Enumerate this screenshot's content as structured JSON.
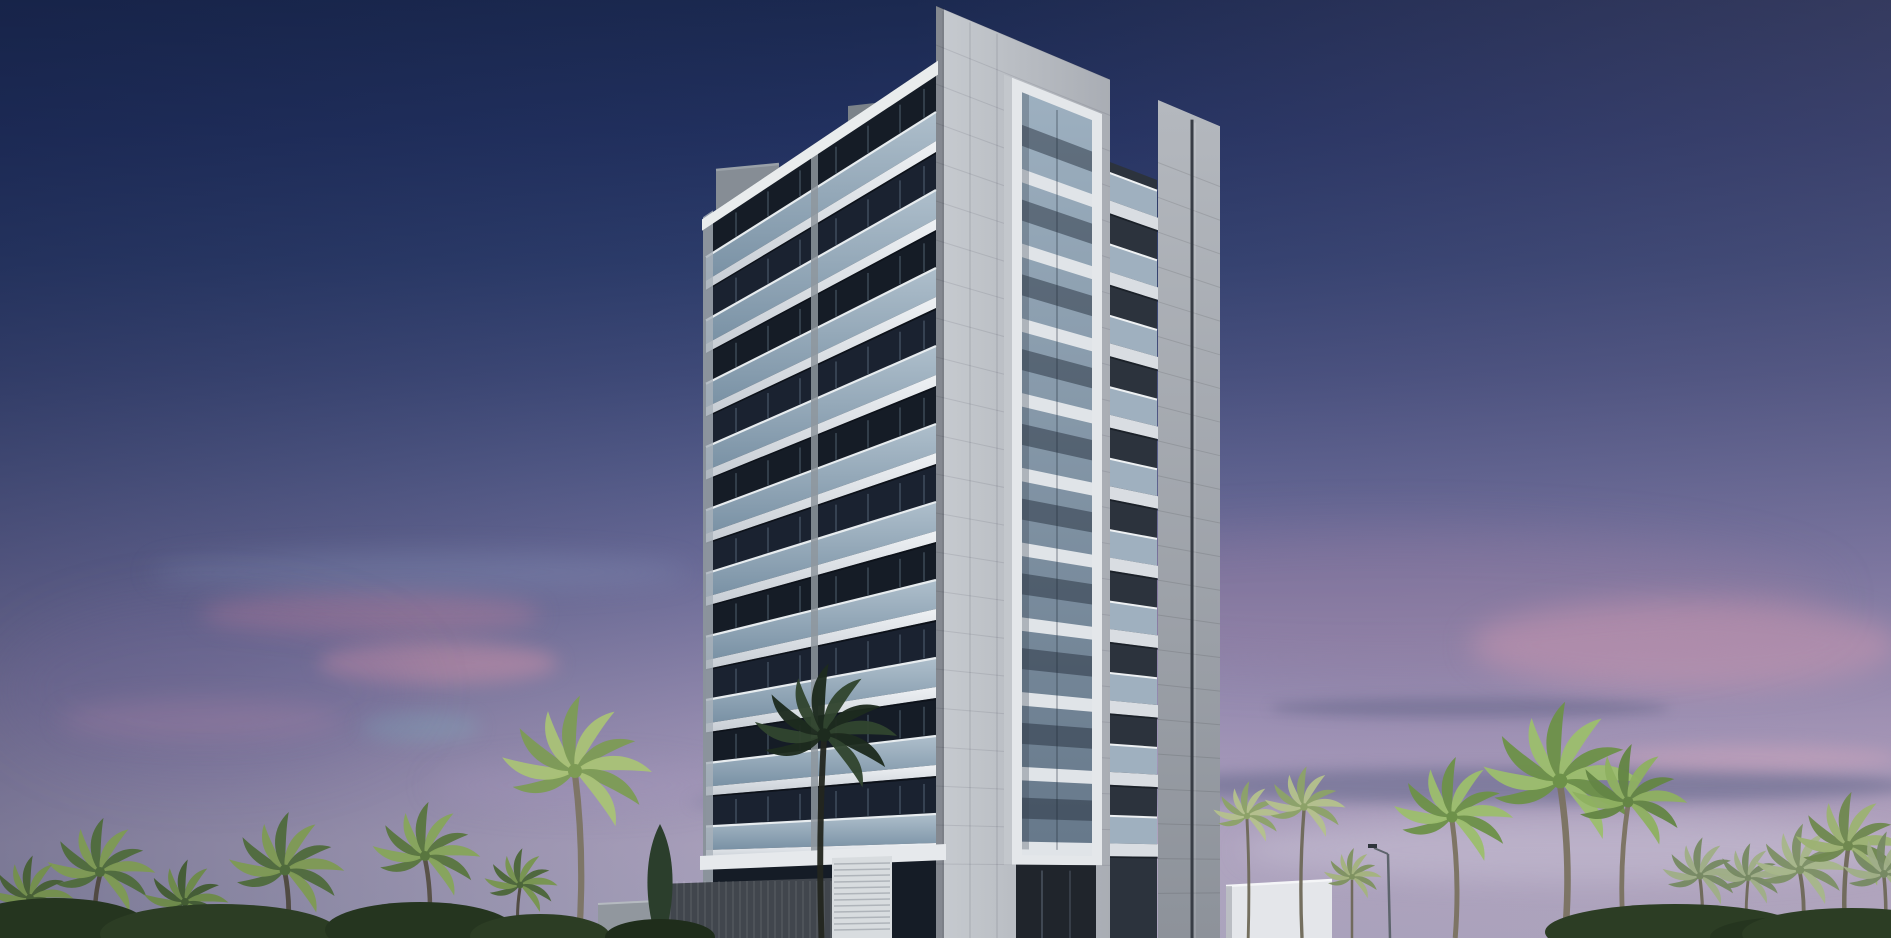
{
  "scene": {
    "title": "dusk-architectural-rendering-of-high-rise-tower-with-palm-trees",
    "sky": {
      "vertical_stops": [
        "#1b2950 0%",
        "#223160 14%",
        "#2e3e6d 28%",
        "#424d7c 40%",
        "#575e8c 50%",
        "#6f6f9c 60%",
        "#8781a9 69%",
        "#9b91b5 77%",
        "#a89dbd 84%",
        "#b1a7c2 90%",
        "#aca7c0 100%"
      ],
      "horizontal_tint": "linear-gradient(90deg, rgba(14,24,58,0.32) 0%, rgba(14,24,58,0.12) 28%, rgba(0,0,0,0) 48%, rgba(150,118,150,0.10) 72%, rgba(186,148,170,0.16) 100%)"
    },
    "clouds": [
      {
        "x": 200,
        "y": 592,
        "w": 340,
        "h": 44,
        "color": "rgba(198,130,158,0.35)",
        "blur": 11
      },
      {
        "x": 318,
        "y": 642,
        "w": 240,
        "h": 42,
        "color": "rgba(220,148,170,0.42)",
        "blur": 9
      },
      {
        "x": 360,
        "y": 712,
        "w": 120,
        "h": 30,
        "color": "rgba(125,182,195,0.25)",
        "blur": 9
      },
      {
        "x": 60,
        "y": 700,
        "w": 280,
        "h": 40,
        "color": "rgba(185,135,168,0.28)",
        "blur": 12
      },
      {
        "x": 150,
        "y": 552,
        "w": 540,
        "h": 40,
        "color": "rgba(148,168,205,0.20)",
        "blur": 13
      },
      {
        "x": 950,
        "y": 530,
        "w": 880,
        "h": 140,
        "color": "rgba(168,132,164,0.26)",
        "blur": 24
      },
      {
        "x": 1470,
        "y": 600,
        "w": 430,
        "h": 90,
        "color": "rgba(224,158,180,0.38)",
        "blur": 14
      },
      {
        "x": 1120,
        "y": 768,
        "w": 800,
        "h": 36,
        "color": "rgba(90,96,132,0.50)",
        "blur": 7
      },
      {
        "x": 690,
        "y": 790,
        "w": 520,
        "h": 24,
        "color": "rgba(90,96,132,0.28)",
        "blur": 7
      },
      {
        "x": 1240,
        "y": 818,
        "w": 680,
        "h": 64,
        "color": "rgba(206,200,218,0.38)",
        "blur": 13
      },
      {
        "x": 1270,
        "y": 698,
        "w": 400,
        "h": 20,
        "color": "rgba(86,90,124,0.40)",
        "blur": 6
      },
      {
        "x": 1600,
        "y": 745,
        "w": 300,
        "h": 26,
        "color": "rgba(222,170,188,0.35)",
        "blur": 8
      },
      {
        "x": 430,
        "y": 760,
        "w": 300,
        "h": 50,
        "color": "rgba(170,150,190,0.22)",
        "blur": 14
      },
      {
        "x": 0,
        "y": 600,
        "w": 420,
        "h": 180,
        "color": "rgba(108,94,148,0.18)",
        "blur": 26
      }
    ],
    "geometry": {
      "width": 1891,
      "height": 938,
      "corner_x": 936,
      "left_x": 706,
      "right_x": 1220,
      "pillar_right": 1110,
      "far_left": 1158,
      "seam_x": 1192,
      "frame": {
        "x1": 1012,
        "x2": 1102,
        "glass1": 1022,
        "glass2": 1092,
        "top": 47,
        "glass_top": 58,
        "glass_bottom": 848,
        "bottom": 864,
        "side_x": 1004
      },
      "balcony_col": {
        "x1": 1103,
        "x2": 1157,
        "back_top": 96
      },
      "vpl": {
        "x": -280,
        "y": 880
      },
      "vpr": {
        "x": 3000,
        "y": 880
      },
      "floors": 10,
      "pitch": 78,
      "first_floor_y": 76,
      "parapet_top": 62,
      "roof_y": 6,
      "divider_x": 811,
      "edge_w": 7,
      "roof_box": {
        "x1": 716,
        "x2": 779,
        "top": 170
      },
      "ac_box": {
        "x1": 848,
        "x2": 884,
        "top": 106,
        "bottom": 136
      }
    },
    "building_colors": {
      "recess_a": "#151c26",
      "recess_b": "#1a2230",
      "mullion": "rgba(140,162,184,0.25)",
      "rail_hi": "#b6c7d4",
      "rail_lo": "#7e97ab",
      "rail_top": "#e7ecef",
      "slab_hi": "#eef1f4",
      "slab_lo": "#c7cdd4",
      "slab_shadow": "rgba(8,12,18,0.60)",
      "parapet": "#e9eced",
      "divider": "#8e969e",
      "edge": "#a9b2ba",
      "roof_box": "#868d95",
      "ac_box": "#7b8289",
      "pillar_hi": "#c7cbd0",
      "pillar_lo": "#a9adb4",
      "tile_seam": "rgba(55,60,70,0.12)",
      "corner_shade": "rgba(10,15,25,0.35)",
      "frame_white": "#e4e7ea",
      "frame_side": "#c3c7cc",
      "glass_hi": "#9db0c0",
      "glass_lo": "#66788a",
      "sill": "#e0e4e8",
      "transom": "rgba(38,48,62,0.50)",
      "glass_shadow": "rgba(60,70,82,0.30)",
      "balc_back": "#2c333d",
      "balc_glass": "#a9bbca",
      "balc_rail": "#eef1f3",
      "balc_slab": "#d9dde2",
      "far_hi": "#b4b8be",
      "far_lo": "#8d929a",
      "far_seam": "#383d45",
      "far_seam_hi": "rgba(255,255,255,0.22)",
      "sky_cut": "#2b3a66"
    },
    "podium": {
      "canopy": {
        "x1": 700,
        "x2": 946,
        "y": 850,
        "color": "#e6e9ec"
      },
      "ribbed_wall": {
        "x1": 658,
        "x2": 832,
        "y": 884,
        "color": "#41464d",
        "rib": "rgba(255,255,255,0.07)"
      },
      "grey_box": {
        "x1": 598,
        "x2": 656,
        "y": 904,
        "color": "#91979e"
      },
      "louver_box": {
        "x1": 832,
        "x2": 892,
        "y": 858,
        "color": "#d8dcdf",
        "line": "rgba(70,78,88,0.28)"
      },
      "entrance": {
        "x1": 1016,
        "x2": 1096,
        "y": 864,
        "color": "#20252c"
      },
      "right_wall": {
        "x1": 1226,
        "x2": 1332,
        "y": 884,
        "color": "#e4e6ea"
      },
      "ground": {
        "x1": 0,
        "x2": 580,
        "y": 922,
        "color": "#2a3326"
      }
    },
    "street_lamp": {
      "x": 1390,
      "base_y": 938,
      "top_y": 854,
      "pole": "#5d646c",
      "head": "#2f353c"
    },
    "vegetation": {
      "palms": [
        {
          "x": 100,
          "top": 844,
          "r": 56,
          "lean": 8,
          "c1": "#7e9a53",
          "c2": "#4f6b3c",
          "trunk": "#4e483e"
        },
        {
          "x": 30,
          "top": 876,
          "r": 44,
          "lean": -4,
          "c1": "#74904c",
          "c2": "#475f35",
          "trunk": "#4e483e"
        },
        {
          "x": 285,
          "top": 840,
          "r": 60,
          "lean": -6,
          "c1": "#7e9a53",
          "c2": "#4f6b3c",
          "trunk": "#4e483e"
        },
        {
          "x": 185,
          "top": 880,
          "r": 44,
          "lean": 4,
          "c1": "#6d8a49",
          "c2": "#435c33",
          "trunk": "#443f36"
        },
        {
          "x": 425,
          "top": 828,
          "r": 56,
          "lean": -8,
          "c1": "#86a45b",
          "c2": "#59763f",
          "trunk": "#554f43"
        },
        {
          "x": 520,
          "top": 866,
          "r": 38,
          "lean": 4,
          "c1": "#78954f",
          "c2": "#4c6639",
          "trunk": "#4e483e"
        },
        {
          "x": 575,
          "top": 732,
          "r": 78,
          "lean": -10,
          "c1": "#a9c277",
          "c2": "#7d9b55",
          "trunk": "#7c7463"
        },
        {
          "x": 824,
          "top": 698,
          "r": 74,
          "lean": 6,
          "c1": "#31452f",
          "c2": "#1d2b1e",
          "trunk": "#23261f"
        },
        {
          "x": 1247,
          "top": 798,
          "r": 36,
          "lean": -3,
          "c1": "#b4c18c",
          "c2": "#8da268",
          "trunk": "#6e6857"
        },
        {
          "x": 1304,
          "top": 786,
          "r": 42,
          "lean": 5,
          "c1": "#b4c18c",
          "c2": "#8da268",
          "trunk": "#6e6857"
        },
        {
          "x": 1352,
          "top": 862,
          "r": 30,
          "lean": 0,
          "c1": "#a4b37e",
          "c2": "#7f9260",
          "trunk": "#6e6857"
        },
        {
          "x": 1452,
          "top": 786,
          "r": 62,
          "lean": -8,
          "c1": "#9cbd6d",
          "c2": "#6d9149",
          "trunk": "#7a7260"
        },
        {
          "x": 1560,
          "top": 740,
          "r": 82,
          "lean": -12,
          "c1": "#9cbd6d",
          "c2": "#6d9149",
          "trunk": "#7a7260"
        },
        {
          "x": 1628,
          "top": 772,
          "r": 60,
          "lean": 10,
          "c1": "#8fb061",
          "c2": "#648545",
          "trunk": "#7a7260"
        },
        {
          "x": 1700,
          "top": 856,
          "r": 40,
          "lean": -4,
          "c1": "#9fae86",
          "c2": "#778963",
          "trunk": "#6e6857"
        },
        {
          "x": 1748,
          "top": 860,
          "r": 36,
          "lean": 3,
          "c1": "#9fae86",
          "c2": "#778963",
          "trunk": "#6e6857"
        },
        {
          "x": 1800,
          "top": 846,
          "r": 48,
          "lean": -6,
          "c1": "#a7b689",
          "c2": "#7d9065",
          "trunk": "#6e6857"
        },
        {
          "x": 1848,
          "top": 818,
          "r": 56,
          "lean": 6,
          "c1": "#9cb272",
          "c2": "#6f884f",
          "trunk": "#6e6857"
        },
        {
          "x": 1884,
          "top": 852,
          "r": 44,
          "lean": -3,
          "c1": "#9fae86",
          "c2": "#778963",
          "trunk": "#6e6857"
        }
      ],
      "cypress": [
        {
          "x": 660,
          "top": 824,
          "rx": 16,
          "color": "#2b3e2c"
        }
      ],
      "bushes": [
        {
          "x": 55,
          "y": 928,
          "rx": 95,
          "ry": 30,
          "color": "#25351f"
        },
        {
          "x": 220,
          "y": 934,
          "rx": 120,
          "ry": 30,
          "color": "#2c3d24"
        },
        {
          "x": 420,
          "y": 930,
          "rx": 95,
          "ry": 28,
          "color": "#25351f"
        },
        {
          "x": 540,
          "y": 936,
          "rx": 70,
          "ry": 22,
          "color": "#2c3d24"
        },
        {
          "x": 660,
          "y": 937,
          "rx": 55,
          "ry": 18,
          "color": "#1f2d1b"
        },
        {
          "x": 1675,
          "y": 932,
          "rx": 130,
          "ry": 28,
          "color": "#2c3d24"
        },
        {
          "x": 1790,
          "y": 937,
          "rx": 80,
          "ry": 20,
          "color": "#25351f"
        },
        {
          "x": 1852,
          "y": 934,
          "rx": 110,
          "ry": 26,
          "color": "#2c3d24"
        }
      ]
    }
  }
}
